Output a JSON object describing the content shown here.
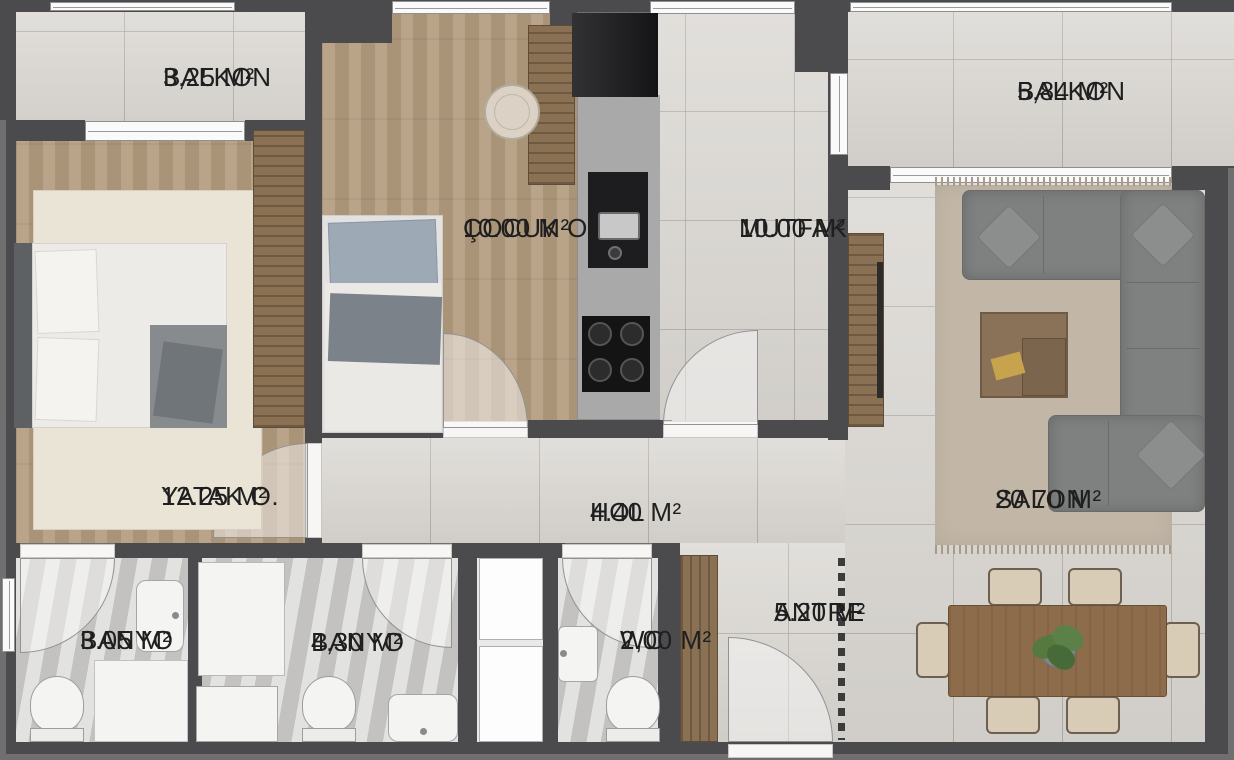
{
  "plan": {
    "rooms": [
      {
        "id": "balkon_left",
        "label": "BALKON",
        "area": "3,25 M²"
      },
      {
        "id": "cocuk_odasi",
        "label": "ÇOCUK O.",
        "area": "10.00 M²"
      },
      {
        "id": "mutfak",
        "label": "MUTFAK",
        "area": "10.00 M²"
      },
      {
        "id": "balkon_right",
        "label": "BALKON",
        "area": "5,84 M²"
      },
      {
        "id": "yatak_odasi",
        "label": "YATAK O.",
        "area": "12.25 M²"
      },
      {
        "id": "hol",
        "label": "HOL",
        "area": "4.40 M²"
      },
      {
        "id": "salon",
        "label": "SALON",
        "area": "20.70 M²"
      },
      {
        "id": "banyo_small",
        "label": "BANYO",
        "area": "3.05 M²"
      },
      {
        "id": "banyo_large",
        "label": "BANYO",
        "area": "4,30 M²"
      },
      {
        "id": "wc",
        "label": "WC",
        "area": "2,00 M²"
      },
      {
        "id": "antre",
        "label": "ANTRE",
        "area": "5.20 M²"
      }
    ]
  },
  "palette": {
    "wall": "#4b4b4d",
    "outer-edge": "#6f6f6f",
    "tile": "#d9d6d1",
    "wood": "#b59d80",
    "wood-dark": "#8a7154",
    "bath": "#cbcac8",
    "counter": "#a9a9a9",
    "appliance": "#1d1d1f",
    "sofa": "#7e817f",
    "rug-salon": "#c2b7a7",
    "rug-bed": "#eae4d7",
    "table-wood": "#8d6c4b",
    "chair": "#d8ccb6",
    "plant": "#55793f",
    "fixture": "#f4f4f3",
    "window": "#fafafa",
    "dash": "#3c3c3c",
    "label": "#1f1f1f"
  }
}
